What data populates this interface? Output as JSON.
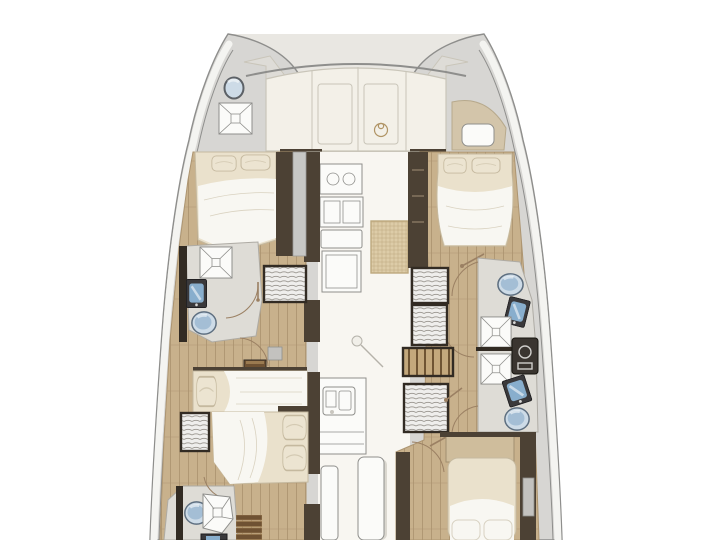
{
  "page": {
    "description": "Catamaran sailing yacht interior layout floor plan, bow at top, four cabins",
    "visible_text": ""
  },
  "colors": {
    "bg": "#ffffff",
    "bridge": "#e9e7e2",
    "hull-shell": "#d7d6d3",
    "hull-line": "#8e8e8c",
    "hull-white": "#f4f4f1",
    "deck-grey": "#dedcd7",
    "foredeck": "#f3f0e8",
    "panel-line": "#c9c5b9",
    "saloon": "#f8f6f1",
    "wall-dark": "#4c4134",
    "wall-darker": "#322b23",
    "wood": "#c8b18c",
    "wood-line": "#ad9571",
    "bed": "#eae1cc",
    "bed-line": "#c5b99f",
    "sheet": "#f8f7f2",
    "pillow": "#ece4d1",
    "bath-floor": "#dedcd6",
    "bath-line": "#aeaba4",
    "fixture-white": "#fbfbf9",
    "fixture-line": "#8f8f8c",
    "toilet-fill": "#cddbe7",
    "toilet-deep": "#9cb8d1",
    "toilet-line": "#5e6f80",
    "sink-dark": "#3a393b",
    "sink-blue": "#88aecd",
    "step-brown": "#6f5233",
    "step-light": "#9a7a50",
    "slat-light": "#c3a87c",
    "slat-dark": "#6e5433",
    "louver-bg": "#efeeec",
    "louver-line": "#98948e",
    "rattan-bg": "#ddcca8",
    "rattan-line": "#bda87e",
    "arc": "#9b8063",
    "mirror": "#c7c7c5",
    "grey-item": "#c3c2bf",
    "emblem": "#b09465",
    "headboard": "#cfbd9c"
  },
  "rooms": {
    "plan": "catamaran floor plan viewed from above, bow up",
    "port_hull": "port hull with forward double cabin, forward head, midship berth, aft double cabin and aft head",
    "starboard_hull": "starboard hull with forward island double cabin, two heads and aft double cabin",
    "foredeck": "solid foredeck with two deck hatches and deck fitting",
    "saloon": "central saloon and galley with stove, worktops, sink and table",
    "port_forward_cabin": "port forward double berth",
    "port_forward_head": "port forward head with shower, washbasin and toilet",
    "port_mid_berth": "port midship guest berth",
    "port_aft_cabin": "port aft double berth",
    "port_aft_head": "port aft head with shower, toilet and companionway steps",
    "starboard_forward_cabin": "starboard forward island double berth",
    "starboard_forward_head": "starboard forward head with toilet, washbasin and shower",
    "starboard_aft_head": "starboard aft head with shower, washbasin, toilet and appliance",
    "starboard_aft_cabin": "starboard aft double berth"
  },
  "fixtures": {
    "toilet": "marine toilet",
    "shower": "shower tray with drain",
    "washbasin": "washbasin",
    "pillow": "berth pillow",
    "steps": "companionway steps",
    "stove": "two-burner galley stove",
    "galley_sink": "double galley sink",
    "saloon_table": "woven-top saloon table",
    "deck_hatch": "foredeck escape hatch",
    "porthole": "bow porthole",
    "washer": "appliance / control panel",
    "wardrobe": "louvered wardrobe locker",
    "door": "door swing arc"
  }
}
